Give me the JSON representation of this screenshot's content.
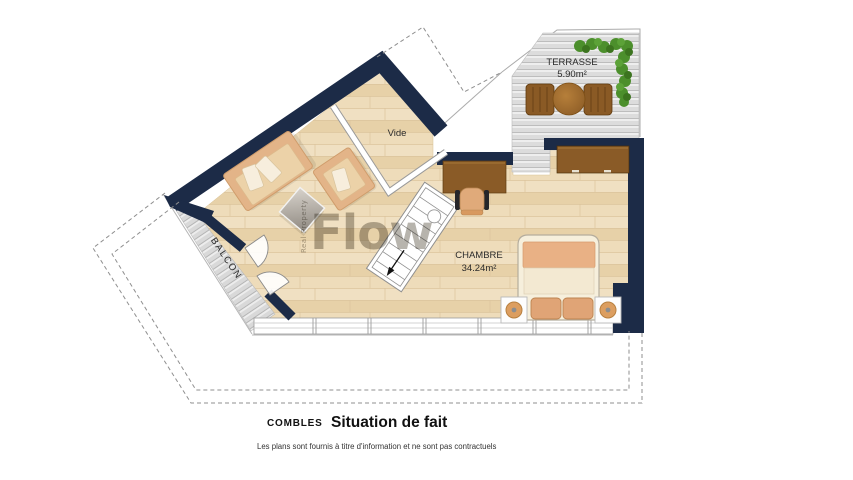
{
  "plan": {
    "rooms": {
      "terrasse": {
        "name": "TERRASSE",
        "area": "5.90m²"
      },
      "chambre": {
        "name": "CHAMBRE",
        "area": "34.24m²"
      },
      "vide": {
        "name": "Vide"
      },
      "balcon": {
        "name": "BALCON"
      }
    },
    "watermark": {
      "brand": "Flow",
      "tagline": "Real Property"
    }
  },
  "caption": {
    "level": "COMBLES",
    "title": "Situation de fait",
    "disclaimer": "Les plans sont fournis à titre d'information et ne sont pas contractuels"
  },
  "colors": {
    "wall": "#1c2b47",
    "floor": "#ecd9b6",
    "deck": "#dcdcdc",
    "hedge": "#4c8f2c",
    "wood_furniture": "#8a5b27",
    "upholstery": "#e3b488"
  }
}
